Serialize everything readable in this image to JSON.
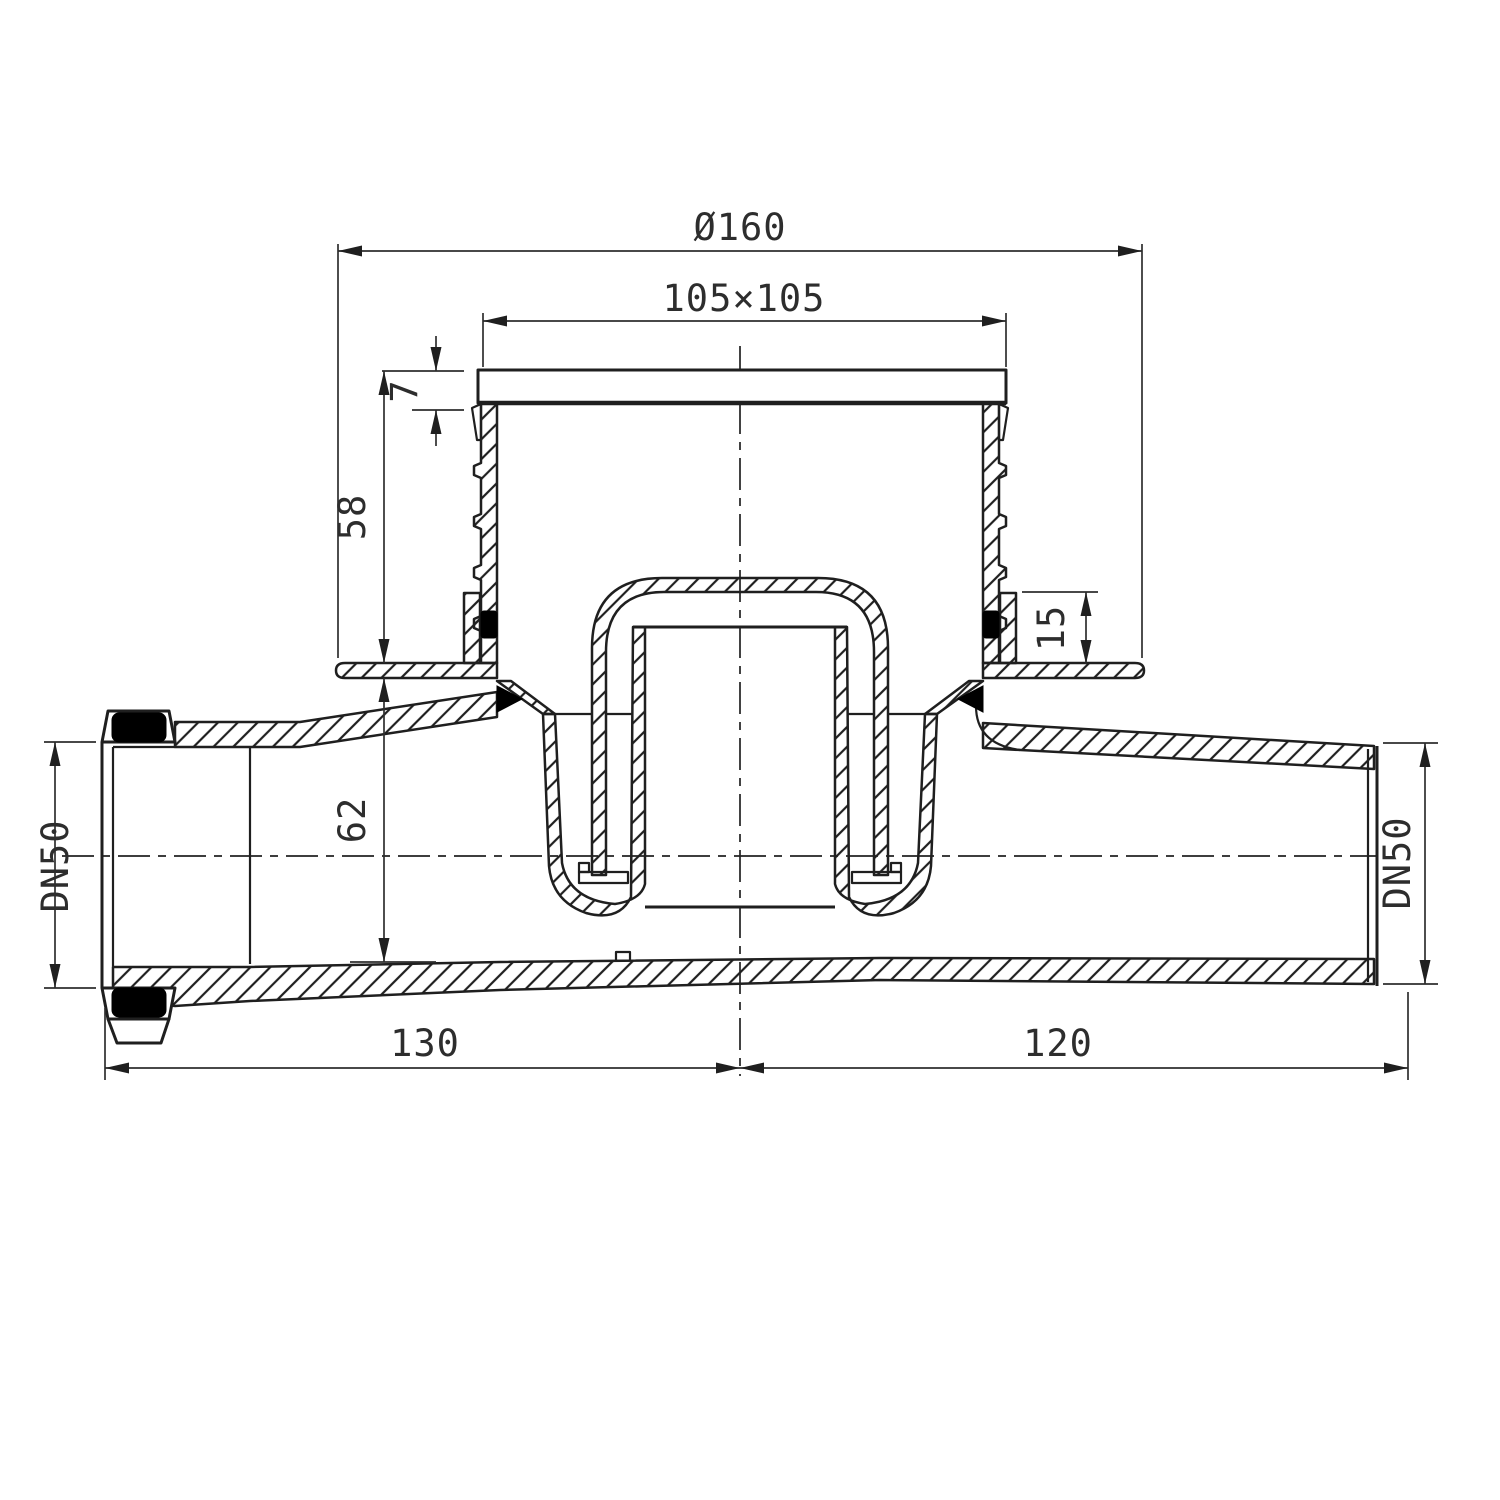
{
  "drawing": {
    "title": "floor-drain-cross-section",
    "background_color": "#ffffff",
    "line_color": "#1f1f1f",
    "text_color": "#2d2d2d",
    "seal_color": "#000000",
    "dimensions": {
      "top_diameter": "Ø160",
      "grate_size": "105×105",
      "lid_thickness": "7",
      "riser_height": "58",
      "clamp_height": "15",
      "body_depth": "62",
      "inlet_length": "130",
      "outlet_length": "120",
      "inlet_pipe": "DN50",
      "outlet_pipe": "DN50"
    }
  }
}
